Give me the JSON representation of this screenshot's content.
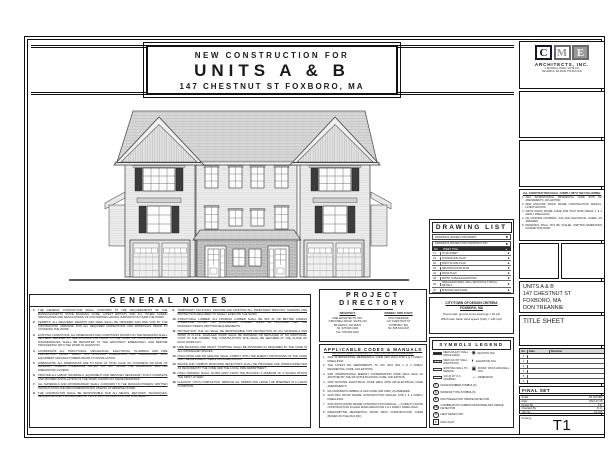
{
  "title_banner": {
    "line1": "NEW CONSTRUCTION FOR",
    "line2": "UNITS A & B",
    "line3": "147 CHESTNUT ST FOXBORO, MA"
  },
  "drawing_list": {
    "title": "DRAWING LIST",
    "dot": "●",
    "issued": [
      "DRAWINGS ISSUED FOR PERMIT",
      "DRAWINGS ISSUED FOR CONSTRUCTION"
    ],
    "header": {
      "no": "NO.",
      "title": "SHEET TITLE",
      "mark": "●"
    },
    "rows": [
      {
        "no": "T1",
        "title": "TITLE SHEET"
      },
      {
        "no": "A1",
        "title": "FOUNDATION PLAN"
      },
      {
        "no": "A2",
        "title": "FIRST FLOOR PLAN"
      },
      {
        "no": "A3",
        "title": "SECOND FLOOR PLAN"
      },
      {
        "no": "A4",
        "title": "ROOF PLAN"
      },
      {
        "no": "A5",
        "title": "FRONT & REAR ELEVATIONS"
      },
      {
        "no": "A6",
        "title": "SIDE ELEVATIONS, WALL SECTION & TYPICAL DETAILS"
      },
      {
        "no": "A7",
        "title": "BUILDING SECTIONS"
      },
      {
        "no": "A8",
        "title": "FIRST & SECOND FLOOR ELECTRICAL PLANS"
      },
      {
        "no": "A9",
        "title": "SMOKE & CO DETECTOR PLANS, NOTES & DETAILS"
      }
    ]
  },
  "general_notes": {
    "title": "GENERAL NOTES",
    "col1": [
      {
        "n": "1.",
        "t": "THE GENERAL CONTRACTOR SHALL CONFORM TO THE REQUIREMENTS OF THE MASSACHUSETTS STATE BUILDING CODE, LATEST EDITION, AND ALL OTHER CODES, ORDINANCES AND REGULATIONS OF AUTHORITIES HAVING JURISDICTION OVER THE WORK."
      },
      {
        "n": "2.",
        "t": "PERMITS: ALL REQUIRED PERMITS AND FEES SHALL BE OBTAINED AND PAID FOR BY THE CONTRACTOR. ARRANGE FOR ALL REQUIRED INSPECTIONS AND APPROVALS PRIOR TO COVERING THE WORK."
      },
      {
        "n": "3.",
        "t": "EXISTING CONDITIONS: ALL DIMENSIONS AND CONDITIONS SHOWN ON THE DRAWINGS SHALL BE FIELD VERIFIED BY THE CONTRACTOR PRIOR TO THE START OF CONSTRUCTION. ANY DISCREPANCIES SHALL BE REPORTED TO THE ARCHITECT IMMEDIATELY AND BEFORE PROCEEDING WITH THE WORK IN QUESTION."
      },
      {
        "n": "4.",
        "t": "COORDINATE ALL STRUCTURAL, MECHANICAL, ELECTRICAL, PLUMBING AND FIRE PROTECTION WORK. VERIFY ALL ROUGH-IN DIMENSIONS AND CLEARANCES WITH EQUIPMENT MANUFACTURERS PRIOR TO INSTALLATION."
      },
      {
        "n": "5.",
        "t": "DIMENSIONS: ALL DIMENSIONS ARE TO FACE OF STUD, FACE OF CONCRETE OR FACE OF MASONRY UNLESS OTHERWISE NOTED. DO NOT SCALE THE DRAWINGS; WRITTEN DIMENSIONS GOVERN."
      },
      {
        "n": "6.",
        "t": "PROVIDE ALL LABOR, MATERIALS, EQUIPMENT AND SERVICES NECESSARY FOR A COMPLETE AND PROPER INSTALLATION OF THE WORK SHOWN ON THESE DRAWINGS."
      },
      {
        "n": "7.",
        "t": "ALL MATERIALS AND WORKMANSHIP SHALL CONFORM TO THE MANUFACTURERS' WRITTEN INSTRUCTIONS AND RECOMMENDATIONS UNLESS OTHERWISE NOTED."
      },
      {
        "n": "8.",
        "t": "THE CONTRACTOR SHALL BE RESPONSIBLE FOR ALL MEANS, METHODS, TECHNIQUES, SEQUENCES AND PROCEDURES OF CONSTRUCTION AND FOR JOB SITE SAFETY."
      }
    ],
    "col2": [
      {
        "n": "9.",
        "t": "TEMPORARY FACILITIES: PROVIDE AND MAINTAIN ALL TEMPORARY BRACING, SHORING AND PROTECTION REQUIRED TO SAFELY EXECUTE THE WORK."
      },
      {
        "n": "10.",
        "t": "STRUCTURAL LUMBER: ALL FRAMING LUMBER SHALL BE SPF #2 OR BETTER UNLESS OTHERWISE NOTED. ALL ENGINEERED LUMBER SHALL BE INSTALLED PER THE MANUFACTURER'S WRITTEN REQUIREMENTS."
      },
      {
        "n": "11.",
        "t": "PROTECTION: THE GC SHALL BE RESPONSIBLE FOR PROTECTION OF ALL MATERIALS AND WORK IN PLACE. DAMAGED WORK SHALL BE REPAIRED OR REPLACED AT NO ADDITIONAL COST TO THE OWNER. THE CONSTRUCTION SITE SHALL BE SECURED AT THE CLOSE OF EACH WORK DAY."
      },
      {
        "n": "12.",
        "t": "FIRE BLOCKING AND DRAFT STOPPING SHALL BE PROVIDED AS REQUIRED BY THE CODE IN ALL CONCEALED SPACES."
      },
      {
        "n": "13.",
        "t": "INSULATION AND AIR SEALING SHALL COMPLY WITH THE ENERGY PROVISIONS OF THE CODE AND THE RESCHECK / HERS DOCUMENTATION."
      },
      {
        "n": "14.",
        "t": "SMOKE AND CARBON MONOXIDE DETECTORS SHALL BE PROVIDED AND INTERCONNECTED AS REQUIRED BY THE CODE AND THE LOCAL FIRE DEPARTMENT."
      },
      {
        "n": "15.",
        "t": "FINAL GRADING SHALL SLOPE AWAY FROM THE BUILDING A MINIMUM OF 6 INCHES WITHIN THE FIRST 10 FEET."
      },
      {
        "n": "16.",
        "t": "CLEANUP: UPON COMPLETION, REMOVE ALL DEBRIS AND LEAVE THE PREMISES IN A CLEAN CONDITION."
      }
    ]
  },
  "project_directory": {
    "title1": "PROJECT",
    "title2": "DIRECTORY",
    "architect": {
      "heading": "ARCHITECT:",
      "lines": [
        "CME ARCHITECTS, INC.",
        "4 BICKNELL ROAD, SUITE 210",
        "BILLERICA, MA 01821",
        "Tel: 978.663.0100",
        "Fax: 978.663.0101"
      ]
    },
    "owner": {
      "heading": "OWNER / APPLICANT:",
      "lines": [
        "DON TREANNIE",
        "147 CHESTNUT ST",
        "FOXBORO, MA",
        "Tel: 508.543.0147"
      ]
    }
  },
  "codes": {
    "title": "APPLICABLE CODES & MANUALS",
    "intro": "ALL WORK SHALL CONFORM TO THE FOLLOWING, AS AMENDED:",
    "items": [
      {
        "n": "1.",
        "t": "2021 INTERNATIONAL RESIDENTIAL CODE (IRC 2021) FOR 1 & 2 FAMILY DWELLINGS"
      },
      {
        "n": "2.",
        "t": "THE LATEST MA AMENDMENTS TO IRC 2021 (MA 1 & 2 FAMILY RESIDENTIAL CODE, 10th EDITION)"
      },
      {
        "n": "3.",
        "t": "2021 INTERNATIONAL ENERGY CONSERVATION CODE (IECC 2021) AS ADOPTED BY THE MA STATE BUILDING CODE, 10th EDITION"
      },
      {
        "n": "4.",
        "t": "2020 NATIONAL ELECTRICAL CODE (NEC) WITH MA ELECTRICAL CODE AMENDMENTS"
      },
      {
        "n": "5.",
        "t": "MA UNIFORM PLUMBING & GAS CODE (248 CMR), AS AMENDED"
      },
      {
        "n": "6.",
        "t": "2018 AWC WOOD FRAME CONSTRUCTION MANUAL FOR 1 & 2 FAMILY DWELLINGS"
      },
      {
        "n": "7.",
        "t": "2015 WFCM WOOD FRAME CONSTRUCTION MANUAL — GUIDE TO WOOD CONSTRUCTION IN HIGH WIND AREAS FOR 1 & 2 FAMILY DWELLINGS"
      },
      {
        "n": "8.",
        "t": "PRESCRIPTIVE RESIDENTIAL WOOD DECK CONSTRUCTION GUIDE (BASED ON THE 2021 IRC)"
      }
    ]
  },
  "design_criteria": {
    "title": "CITY/TOWN OF DESIGN CRITERIA",
    "town": "FOXBORO, MA",
    "lines": [
      "Snow load: ground snow load (sg) = 40 psf",
      "Wind load: basic wind speed (Vult) = 140 mph"
    ]
  },
  "symbols_legend": {
    "title": "SYMBOLS LEGEND",
    "pairs": [
      {
        "left": "NEW 2x6 EXT. WALL (INSULATED)",
        "rsym": "◉",
        "right": "SECTION TAG"
      },
      {
        "left": "NEW 2x4 INT. WALL (PARTITION)",
        "rsym": "◐",
        "right": "ELEVATION TAG"
      },
      {
        "left": "EXISTING WALL TO REMAIN",
        "rsym": "▣",
        "right": "ROOM / ROOF AND WALL TAG"
      },
      {
        "left": "2x6 @ 16\" O.C. FRAMING",
        "rsym": "↔",
        "right": "DIMENSION"
      }
    ],
    "singles": [
      {
        "sym": "1",
        "label": "DOOR NUMBER SYMBOL(S)"
      },
      {
        "sym": "A",
        "label": "WINDOW TYPE SYMBOL(S)"
      },
      {
        "sym": "S",
        "label": "PHOTOELECTRIC SMOKE DETECTOR"
      },
      {
        "sym": "CS",
        "label": "COMBINATION CARBON MONOXIDE AND SMOKE DETECTOR"
      },
      {
        "sym": "H",
        "label": "HEAT DETECTOR"
      },
      {
        "sym": "F",
        "label": "FAN LIGHT"
      }
    ]
  },
  "sidebar": {
    "logo": {
      "c": "C",
      "m": "M",
      "e": "E",
      "firm": "ARCHITECTS, INC.",
      "addr1": "4 BICKNELL ROAD, SUITE 210",
      "addr2": "BILLERICA, MA 01821   978.663.0100"
    },
    "compliance": {
      "heading": "ALL CONSTRUCTION SHALL COMPLY WITH THE FOLLOWING:",
      "items": [
        {
          "n": "1.",
          "t": "2021 INTERNATIONAL RESIDENTIAL CODE WITH MA AMENDMENTS, 10th EDITION"
        },
        {
          "n": "2.",
          "t": "NEW ENGLAND WOOD FRAME CONSTRUCTION MANUAL, LATEST EDITION"
        },
        {
          "n": "3.",
          "t": "WFCM WOOD FRAME GUIDE FOR HIGH WIND AREAS, 1 & 2 FAMILY DWELLINGS"
        },
        {
          "n": "4.",
          "t": "MA UNIFORM PLUMBING, GAS AND ELECTRICAL CODES, AS AMENDED"
        },
        {
          "n": "5.",
          "t": "DRAWINGS SHALL NOT BE SCALED; WRITTEN DIMENSIONS GOVERN THE WORK"
        }
      ]
    },
    "project_info": [
      "UNITS A & B",
      "147 CHESTNUT ST",
      "FOXBORO, MA",
      "DON TREANNIE"
    ],
    "sheet_title": "TITLE SHEET",
    "revisions": {
      "headers": {
        "no": "No.",
        "date": "Date",
        "revision": "Revision"
      },
      "rows": [
        "1",
        "2",
        "3",
        "4",
        "5",
        "6"
      ]
    },
    "final_set": "FINAL SET",
    "fields": [
      {
        "label": "Scale:",
        "value": "AS NOTED"
      },
      {
        "label": "Date:",
        "value": "2021.07.26"
      },
      {
        "label": "Drawn By:",
        "value": "T.R."
      },
      {
        "label": "Checked By:",
        "value": "D.C."
      },
      {
        "label": "Job No.:",
        "value": "21-016"
      }
    ],
    "drawing_label": "Drawing:",
    "sheet_number": "T1"
  }
}
